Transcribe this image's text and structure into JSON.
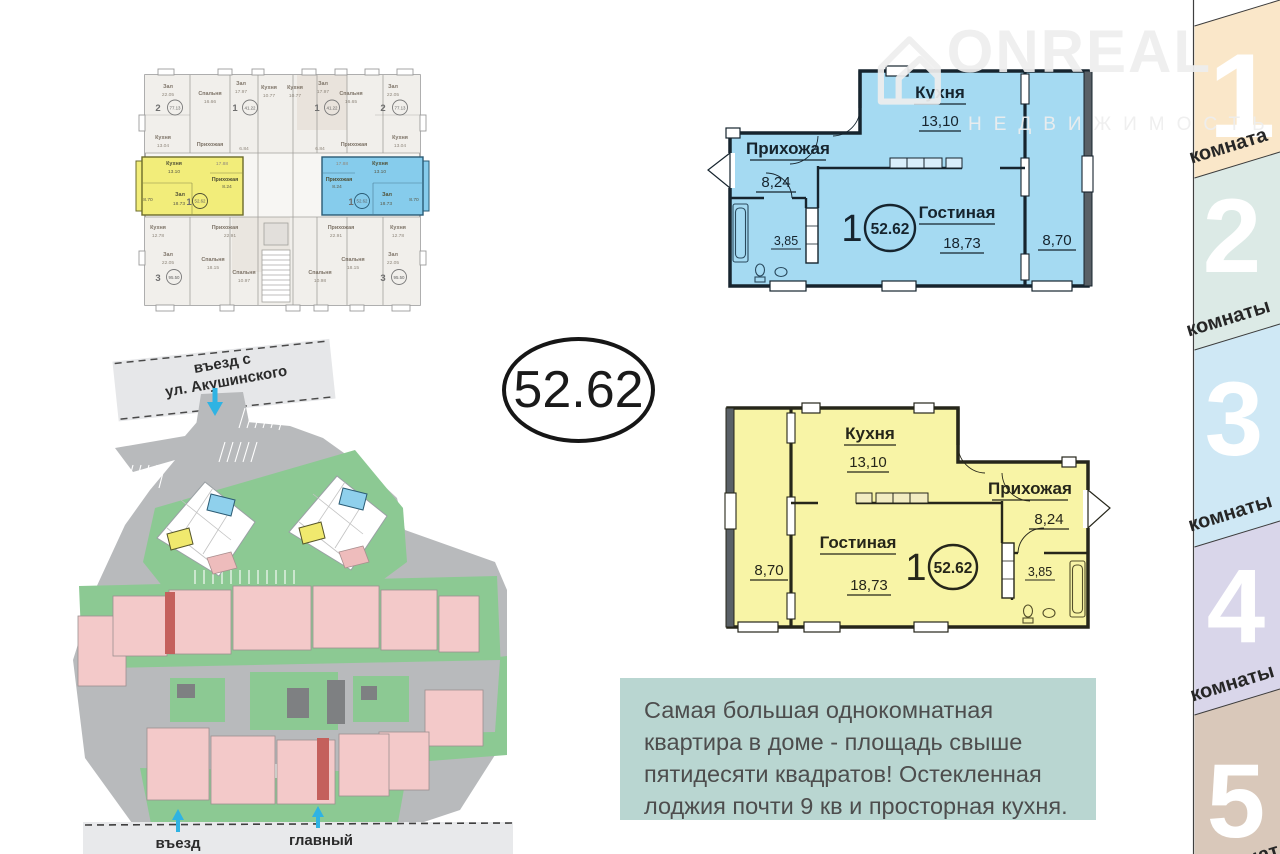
{
  "watermark": {
    "brand": "ONREAL",
    "subtitle": "НЕДВИЖИМОСТЬ"
  },
  "area_badge": "52.62",
  "sidebar": {
    "tabs": [
      {
        "number": "1",
        "label": "комната",
        "color": "#fae7c9"
      },
      {
        "number": "2",
        "label": "комнаты",
        "color": "#dceae6"
      },
      {
        "number": "3",
        "label": "комнаты",
        "color": "#cfe8f5"
      },
      {
        "number": "4",
        "label": "комнаты",
        "color": "#d9d6ea"
      },
      {
        "number": "5",
        "label": "комнат",
        "color": "#d9c8ba"
      }
    ]
  },
  "plan_blue": {
    "rooms": {
      "kitchen": {
        "name": "Кухня",
        "area": "13,10"
      },
      "hall": {
        "name": "Прихожая",
        "area": "8,24"
      },
      "living": {
        "name": "Гостиная",
        "area": "18,73"
      },
      "bath_area": "3,85",
      "loggia_area": "8,70"
    },
    "unit": {
      "rooms_count": "1",
      "total_area": "52.62"
    }
  },
  "plan_yellow": {
    "rooms": {
      "kitchen": {
        "name": "Кухня",
        "area": "13,10"
      },
      "hall": {
        "name": "Прихожая",
        "area": "8,24"
      },
      "living": {
        "name": "Гостиная",
        "area": "18,73"
      },
      "bath_area": "3,85",
      "loggia_area": "8,70"
    },
    "unit": {
      "rooms_count": "1",
      "total_area": "52.62"
    }
  },
  "site_plan": {
    "top_road_line1": "въезд с",
    "top_road_line2": "ул. Акушинского",
    "bottom_entry": "въезд",
    "bottom_main": "главный"
  },
  "description": {
    "text": "Самая большая однокомнатная квартира в доме - площадь свыше пятидесяти квадратов! Остекленная лоджия почти 9 кв и просторная кухня."
  },
  "building_plan": {
    "labels": [
      {
        "t": "Зал",
        "x": 76,
        "y": 33,
        "c": "b-rname"
      },
      {
        "t": "22.05",
        "x": 76,
        "y": 41,
        "c": "b-rnum"
      },
      {
        "t": "2",
        "x": 66,
        "y": 56,
        "c": "b-uno"
      },
      {
        "t": "77.13",
        "x": 83,
        "y": 54.5,
        "c": "b-uarea"
      },
      {
        "t": "Спальня",
        "x": 118,
        "y": 40,
        "c": "b-rname"
      },
      {
        "t": "16.66",
        "x": 118,
        "y": 48,
        "c": "b-rnum"
      },
      {
        "t": "Зал",
        "x": 149,
        "y": 30,
        "c": "b-rname"
      },
      {
        "t": "17.97",
        "x": 149,
        "y": 38,
        "c": "b-rnum"
      },
      {
        "t": "1",
        "x": 143,
        "y": 56,
        "c": "b-uno"
      },
      {
        "t": "41.22",
        "x": 158,
        "y": 54.5,
        "c": "b-uarea"
      },
      {
        "t": "Кухня",
        "x": 177,
        "y": 34,
        "c": "b-rname"
      },
      {
        "t": "10.77",
        "x": 177,
        "y": 42,
        "c": "b-rnum"
      },
      {
        "t": "Кухня",
        "x": 203,
        "y": 34,
        "c": "b-rname"
      },
      {
        "t": "10.77",
        "x": 203,
        "y": 42,
        "c": "b-rnum"
      },
      {
        "t": "Зал",
        "x": 231,
        "y": 30,
        "c": "b-rname"
      },
      {
        "t": "17.97",
        "x": 231,
        "y": 38,
        "c": "b-rnum"
      },
      {
        "t": "1",
        "x": 225,
        "y": 56,
        "c": "b-uno"
      },
      {
        "t": "41.22",
        "x": 240,
        "y": 54.5,
        "c": "b-uarea"
      },
      {
        "t": "Спальня",
        "x": 259,
        "y": 40,
        "c": "b-rname"
      },
      {
        "t": "16.65",
        "x": 259,
        "y": 48,
        "c": "b-rnum"
      },
      {
        "t": "Зал",
        "x": 301,
        "y": 33,
        "c": "b-rname"
      },
      {
        "t": "22.05",
        "x": 301,
        "y": 41,
        "c": "b-rnum"
      },
      {
        "t": "2",
        "x": 291,
        "y": 56,
        "c": "b-uno"
      },
      {
        "t": "77.13",
        "x": 308,
        "y": 54.5,
        "c": "b-uarea"
      },
      {
        "t": "Кухня",
        "x": 71,
        "y": 84,
        "c": "b-rname"
      },
      {
        "t": "13.04",
        "x": 71,
        "y": 92,
        "c": "b-rnum"
      },
      {
        "t": "Прихожая",
        "x": 118,
        "y": 91,
        "c": "b-rname"
      },
      {
        "t": "17.88",
        "x": 130,
        "y": 110,
        "c": "b-rnum"
      },
      {
        "t": "6.84",
        "x": 152,
        "y": 95,
        "c": "b-rnum"
      },
      {
        "t": "6.84",
        "x": 228,
        "y": 95,
        "c": "b-rnum"
      },
      {
        "t": "Прихожая",
        "x": 262,
        "y": 91,
        "c": "b-rname"
      },
      {
        "t": "17.88",
        "x": 250,
        "y": 110,
        "c": "b-rnum"
      },
      {
        "t": "Кухня",
        "x": 308,
        "y": 84,
        "c": "b-rname"
      },
      {
        "t": "13.04",
        "x": 308,
        "y": 92,
        "c": "b-rnum"
      },
      {
        "t": "Кухня",
        "x": 82,
        "y": 110,
        "c": "b-hlname"
      },
      {
        "t": "13.10",
        "x": 82,
        "y": 118,
        "c": "b-hlnum"
      },
      {
        "t": "Прихожая",
        "x": 133,
        "y": 126,
        "c": "b-hlname"
      },
      {
        "t": "8.24",
        "x": 135,
        "y": 133,
        "c": "b-hlnum"
      },
      {
        "t": "Зал",
        "x": 88,
        "y": 141,
        "c": "b-hlname"
      },
      {
        "t": "18.73",
        "x": 87,
        "y": 150,
        "c": "b-hlnum"
      },
      {
        "t": "1",
        "x": 97,
        "y": 150,
        "c": "b-uno"
      },
      {
        "t": "52.62",
        "x": 108,
        "y": 147.5,
        "c": "b-uarea"
      },
      {
        "t": "8.70",
        "x": 56,
        "y": 146,
        "c": "b-hlnum"
      },
      {
        "t": "Прихожая",
        "x": 247,
        "y": 126,
        "c": "b-hlname"
      },
      {
        "t": "8.24",
        "x": 245,
        "y": 133,
        "c": "b-hlnum"
      },
      {
        "t": "Кухня",
        "x": 288,
        "y": 110,
        "c": "b-hlname"
      },
      {
        "t": "13.10",
        "x": 288,
        "y": 118,
        "c": "b-hlnum"
      },
      {
        "t": "Зал",
        "x": 295,
        "y": 141,
        "c": "b-hlname"
      },
      {
        "t": "18.73",
        "x": 294,
        "y": 150,
        "c": "b-hlnum"
      },
      {
        "t": "1",
        "x": 259,
        "y": 150,
        "c": "b-uno"
      },
      {
        "t": "52.62",
        "x": 270,
        "y": 147.5,
        "c": "b-uarea"
      },
      {
        "t": "8.70",
        "x": 322,
        "y": 146,
        "c": "b-hlnum"
      },
      {
        "t": "Кухня",
        "x": 66,
        "y": 174,
        "c": "b-rname"
      },
      {
        "t": "12.78",
        "x": 66,
        "y": 182,
        "c": "b-rnum"
      },
      {
        "t": "Прихожая",
        "x": 133,
        "y": 174,
        "c": "b-rname"
      },
      {
        "t": "22.91",
        "x": 138,
        "y": 182,
        "c": "b-rnum"
      },
      {
        "t": "Зал",
        "x": 76,
        "y": 201,
        "c": "b-rname"
      },
      {
        "t": "22.05",
        "x": 76,
        "y": 209,
        "c": "b-rnum"
      },
      {
        "t": "3",
        "x": 66,
        "y": 226,
        "c": "b-uno"
      },
      {
        "t": "95.50",
        "x": 82,
        "y": 224,
        "c": "b-uarea"
      },
      {
        "t": "Спальня",
        "x": 121,
        "y": 206,
        "c": "b-rname"
      },
      {
        "t": "18.15",
        "x": 121,
        "y": 214,
        "c": "b-rnum"
      },
      {
        "t": "Спальня",
        "x": 152,
        "y": 219,
        "c": "b-rname"
      },
      {
        "t": "10.97",
        "x": 152,
        "y": 227,
        "c": "b-rnum"
      },
      {
        "t": "Прихожая",
        "x": 249,
        "y": 174,
        "c": "b-rname"
      },
      {
        "t": "22.91",
        "x": 244,
        "y": 182,
        "c": "b-rnum"
      },
      {
        "t": "Кухня",
        "x": 306,
        "y": 174,
        "c": "b-rname"
      },
      {
        "t": "12.78",
        "x": 306,
        "y": 182,
        "c": "b-rnum"
      },
      {
        "t": "Спальня",
        "x": 228,
        "y": 219,
        "c": "b-rname"
      },
      {
        "t": "10.98",
        "x": 228,
        "y": 227,
        "c": "b-rnum"
      },
      {
        "t": "Спальня",
        "x": 261,
        "y": 206,
        "c": "b-rname"
      },
      {
        "t": "18.15",
        "x": 261,
        "y": 214,
        "c": "b-rnum"
      },
      {
        "t": "Зал",
        "x": 301,
        "y": 201,
        "c": "b-rname"
      },
      {
        "t": "22.05",
        "x": 301,
        "y": 209,
        "c": "b-rnum"
      },
      {
        "t": "3",
        "x": 291,
        "y": 226,
        "c": "b-uno"
      },
      {
        "t": "95.50",
        "x": 307,
        "y": 224,
        "c": "b-uarea"
      }
    ]
  }
}
